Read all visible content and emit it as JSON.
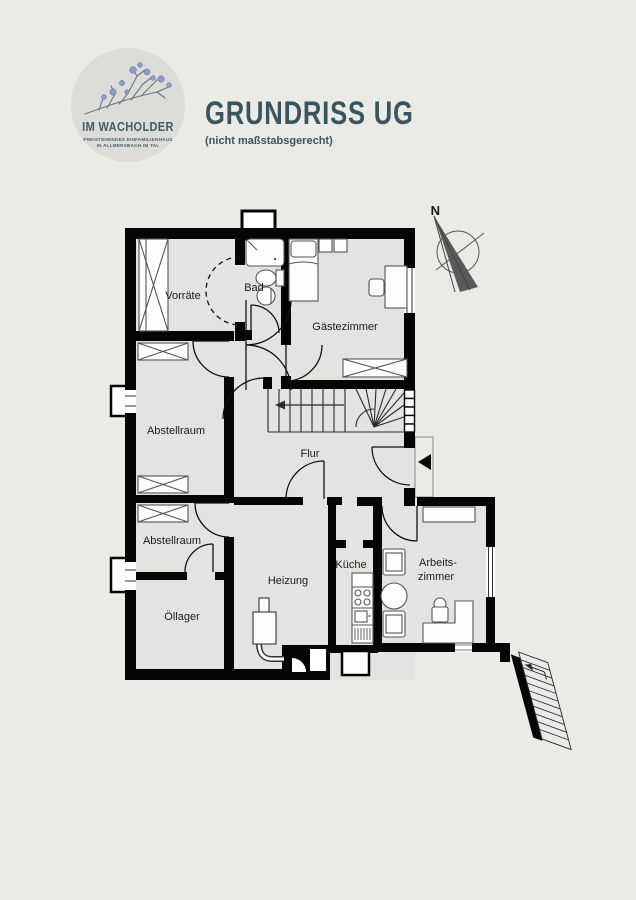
{
  "page": {
    "background": "#eaeae7"
  },
  "header": {
    "logo": {
      "title": "IM WACHOLDER",
      "subtitle_line1": "FREISTEHENDES EINFAMILIENHAUS",
      "subtitle_line2": "IN ALLMERSBACH IM TAL"
    },
    "title": "GRUNDRISS UG",
    "subtitle": "(nicht maßstabsgerecht)"
  },
  "compass": {
    "label": "N"
  },
  "plan": {
    "rooms": {
      "vorraete": "Vorräte",
      "bad": "Bad",
      "gaestezimmer": "Gästezimmer",
      "abstellraum_oben": "Abstellraum",
      "flur": "Flur",
      "abstellraum_unten": "Abstellraum",
      "oellager": "Öllager",
      "heizung": "Heizung",
      "kueche": "Küche",
      "arbeitszimmer_zeile1": "Arbeits-",
      "arbeitszimmer_zeile2": "zimmer"
    },
    "colors": {
      "wall": "#050505",
      "room_fill": "#e3e4e1",
      "accent": "#3e545c",
      "berry": "#8f9ec7"
    }
  }
}
